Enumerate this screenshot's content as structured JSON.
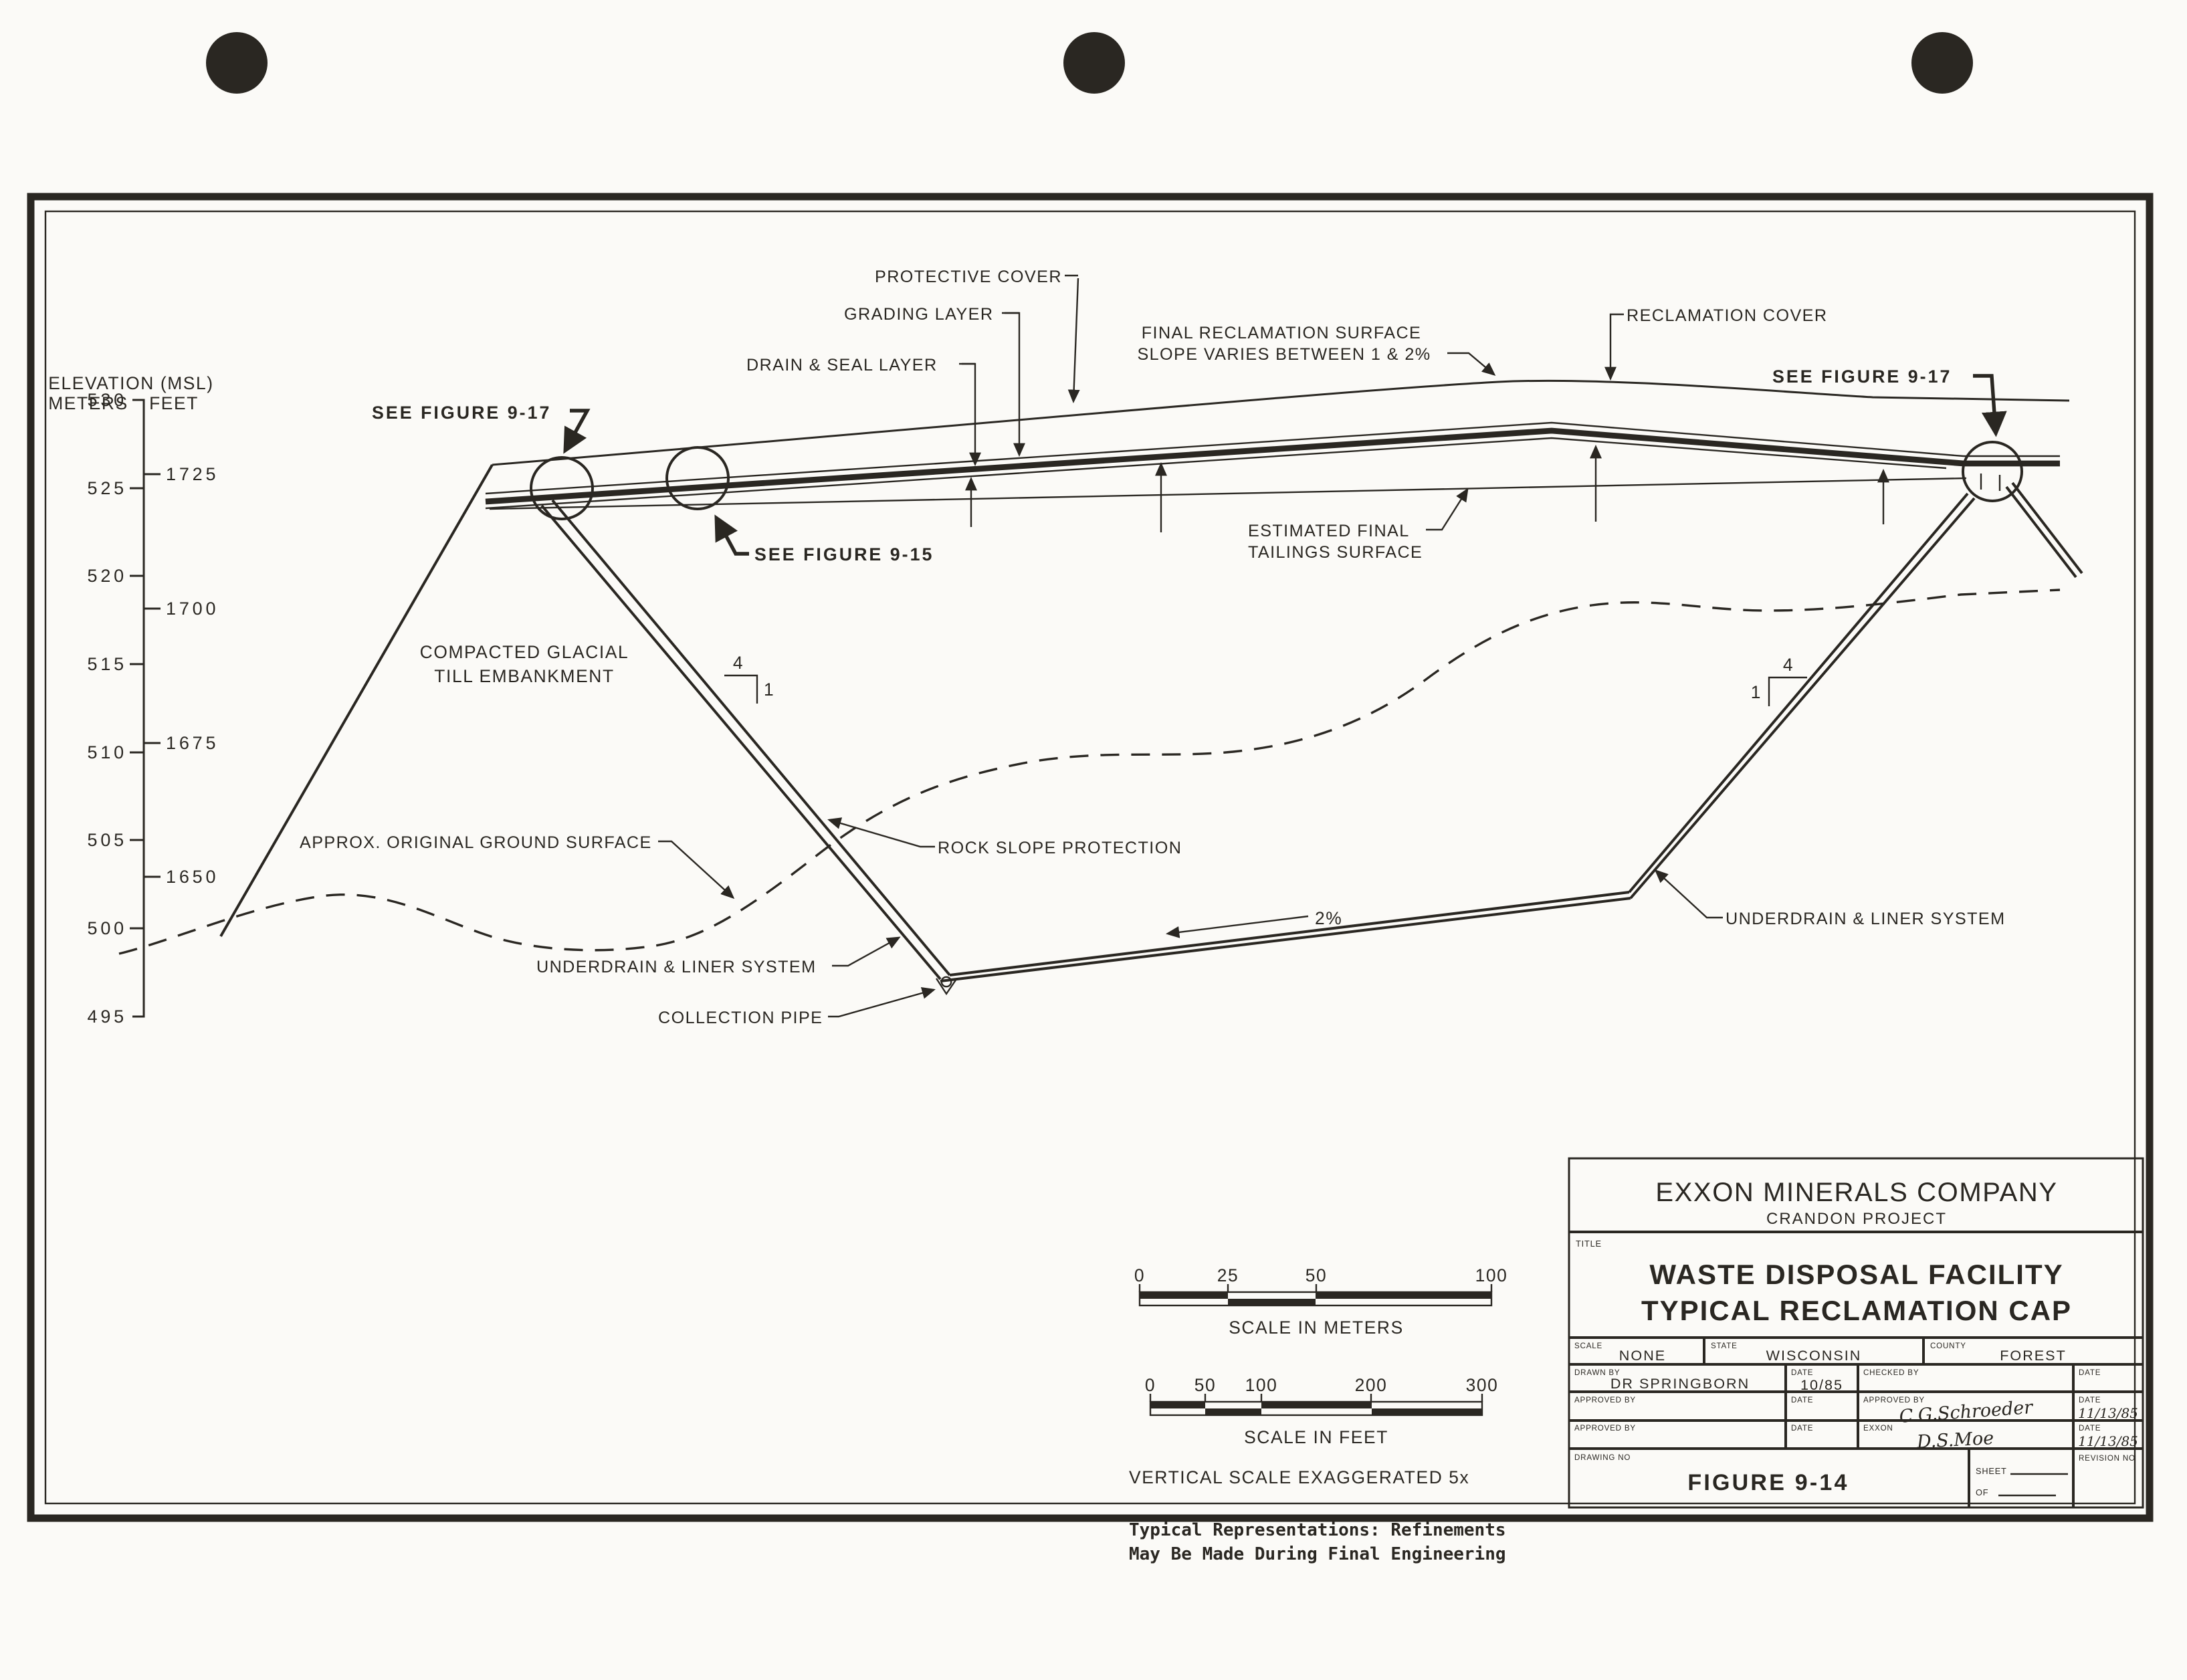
{
  "sheet": {
    "annotations": {
      "protective_cover": "PROTECTIVE COVER",
      "grading_layer": "GRADING LAYER",
      "drain_seal_layer": "DRAIN & SEAL LAYER",
      "final_reclamation_surface_line1": "FINAL RECLAMATION SURFACE",
      "final_reclamation_surface_line2": "SLOPE VARIES BETWEEN 1 & 2%",
      "reclamation_cover": "RECLAMATION COVER",
      "see_figure_9_17": "SEE FIGURE 9-17",
      "see_figure_9_15": "SEE FIGURE 9-15",
      "compacted_glacial_line1": "COMPACTED GLACIAL",
      "compacted_glacial_line2": "TILL EMBANKMENT",
      "estimated_final_line1": "ESTIMATED FINAL",
      "estimated_final_line2": "TAILINGS SURFACE",
      "approx_original_ground": "APPROX. ORIGINAL GROUND SURFACE",
      "rock_slope_protection": "ROCK SLOPE PROTECTION",
      "underdrain_liner_system": "UNDERDRAIN & LINER SYSTEM",
      "collection_pipe": "COLLECTION PIPE",
      "basin_slope": "2%",
      "slope_ratio_horizontal": "4",
      "slope_ratio_vertical": "1"
    },
    "elevation_scale": {
      "title": "ELEVATION (MSL)",
      "meters_heading": "METERS",
      "feet_heading": "FEET",
      "meters_ticks": [
        "530",
        "525",
        "520",
        "515",
        "510",
        "505",
        "500",
        "495"
      ],
      "feet_ticks": [
        "1725",
        "1700",
        "1675",
        "1650"
      ]
    },
    "scale_bars": {
      "meters_ticks": [
        "0",
        "25",
        "50",
        "100"
      ],
      "meters_caption": "SCALE IN METERS",
      "feet_ticks": [
        "0",
        "50",
        "100",
        "200",
        "300"
      ],
      "feet_caption": "SCALE IN FEET",
      "vertical_note": "VERTICAL SCALE EXAGGERATED 5x",
      "disclaimer_line1": "Typical Representations:  Refinements",
      "disclaimer_line2": "May Be Made During Final Engineering"
    },
    "title_block": {
      "company": "EXXON MINERALS COMPANY",
      "project": "CRANDON PROJECT",
      "title_label": "TITLE",
      "title_line1": "WASTE DISPOSAL FACILITY",
      "title_line2": "TYPICAL RECLAMATION CAP",
      "scale_label": "SCALE",
      "scale_value": "NONE",
      "state_label": "STATE",
      "state_value": "WISCONSIN",
      "county_label": "COUNTY",
      "county_value": "FOREST",
      "drawn_by_label": "DRAWN BY",
      "drawn_by_value": "DR SPRINGBORN",
      "date_label": "DATE",
      "drawn_date": "10/85",
      "checked_by_label": "CHECKED BY",
      "approved_by_label": "APPROVED BY",
      "approved_signature": "C.G.Schroeder",
      "approved_date": "11/13/85",
      "exxon_label": "EXXON",
      "exxon_signature": "D.S.Moe",
      "exxon_date": "11/13/85",
      "drawing_no_label": "DRAWING NO",
      "drawing_no_value": "FIGURE 9-14",
      "sheet_label": "SHEET",
      "of_label": "OF",
      "revision_label": "REVISION NO"
    },
    "colors": {
      "ink": "#2a2722",
      "paper": "#fbfaf7"
    }
  }
}
